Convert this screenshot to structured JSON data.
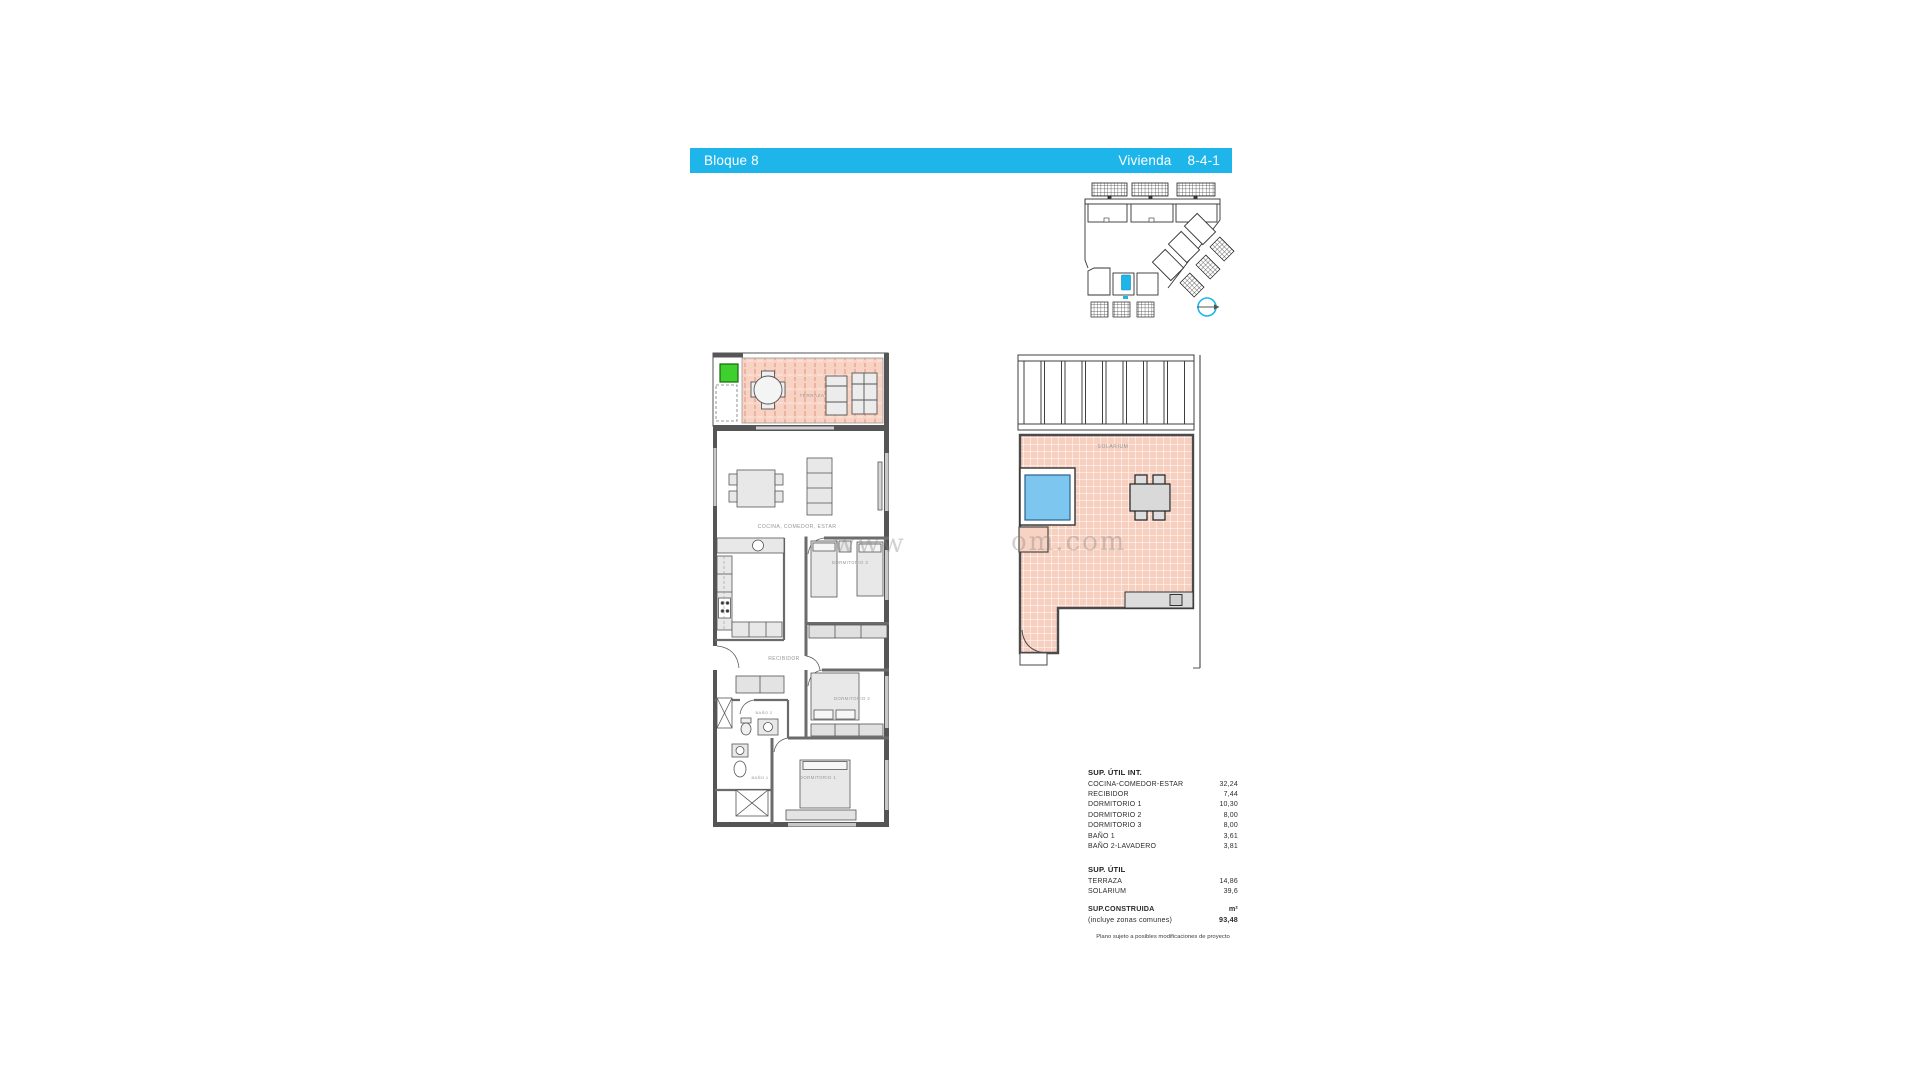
{
  "header": {
    "block_label": "Bloque 8",
    "unit_label": "Vivienda",
    "unit_number": "8-4-1"
  },
  "colors": {
    "accent": "#1eb6ea",
    "floor_fill": "#f8d2c2",
    "pool_fill": "#7cc6f0",
    "green_fill": "#3ed02c",
    "wall": "#555555"
  },
  "floor_plan": {
    "labels": {
      "terraza": "TERRAZA",
      "cocina": "COCINA, COMEDOR, ESTAR",
      "dormitorio3": "DORMITORIO 3",
      "recibidor": "RECIBIDOR",
      "dormitorio2": "DORMITORIO 2",
      "bano2": "BAÑO 2",
      "bano1": "BAÑO 1",
      "dormitorio1": "DORMITORIO 1"
    }
  },
  "solarium_plan": {
    "label": "SOLARIUM"
  },
  "watermark": {
    "left_fragment": "www",
    "right_fragment": "om.com"
  },
  "tables": {
    "sup_util_int": {
      "title": "SUP. ÚTIL INT.",
      "rows": [
        {
          "label": "COCINA-COMEDOR-ESTAR",
          "value": "32,24"
        },
        {
          "label": "RECIBIDOR",
          "value": "7,44"
        },
        {
          "label": "DORMITORIO 1",
          "value": "10,30"
        },
        {
          "label": "DORMITORIO 2",
          "value": "8,00"
        },
        {
          "label": "DORMITORIO 3",
          "value": "8,00"
        },
        {
          "label": "BAÑO 1",
          "value": "3,61"
        },
        {
          "label": "BAÑO 2-LAVADERO",
          "value": "3,81"
        }
      ]
    },
    "sup_util": {
      "title": "SUP. ÚTIL",
      "rows": [
        {
          "label": "TERRAZA",
          "value": "14,86"
        },
        {
          "label": "SOLARIUM",
          "value": "39,6"
        }
      ]
    },
    "sup_construida": {
      "title": "SUP.CONSTRUIDA",
      "unit": "m²",
      "subtitle": "(incluye zonas comunes)",
      "value": "93,48"
    },
    "footnote": "Plano sujeto a posibles modificaciones de proyecto"
  }
}
